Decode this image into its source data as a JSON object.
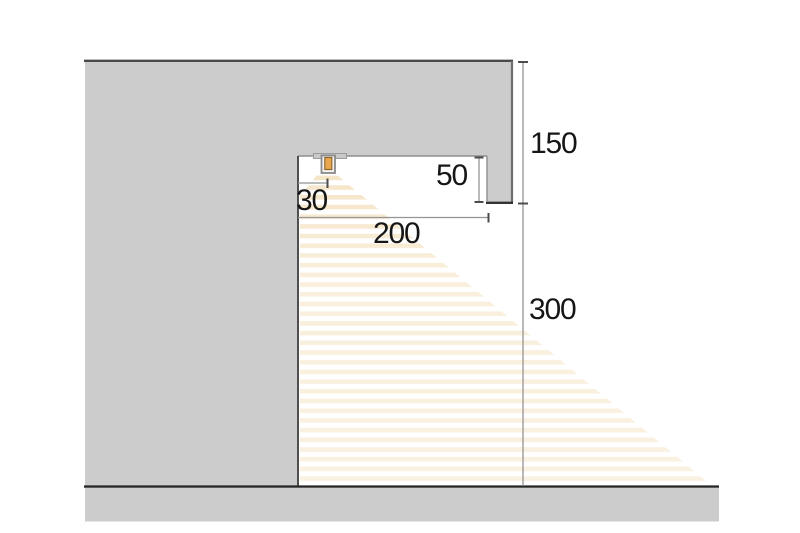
{
  "diagram": {
    "kind": "cove-lighting-cross-section",
    "dimension_labels": {
      "recess_total_height": "150",
      "fascia_height": "50",
      "led_inset": "30",
      "recess_width": "200",
      "wall_drop_height": "300"
    },
    "icons": {
      "led": "led-strip-icon"
    },
    "colors": {
      "background": "#ffffff",
      "structure_fill": "#cccccc",
      "outline_dark": "#3a3a3a",
      "outline_medium": "#8f8f8f",
      "ground_line": "#262626",
      "dimension_line": "#949494",
      "dimension_tick": "#4d4d4d",
      "label_text": "#161616",
      "beam_stripe": "#f5e3c2",
      "led_core": "#e9a64f",
      "led_core_outline": "#8d6227",
      "led_frame": "#8a8a8a"
    }
  }
}
